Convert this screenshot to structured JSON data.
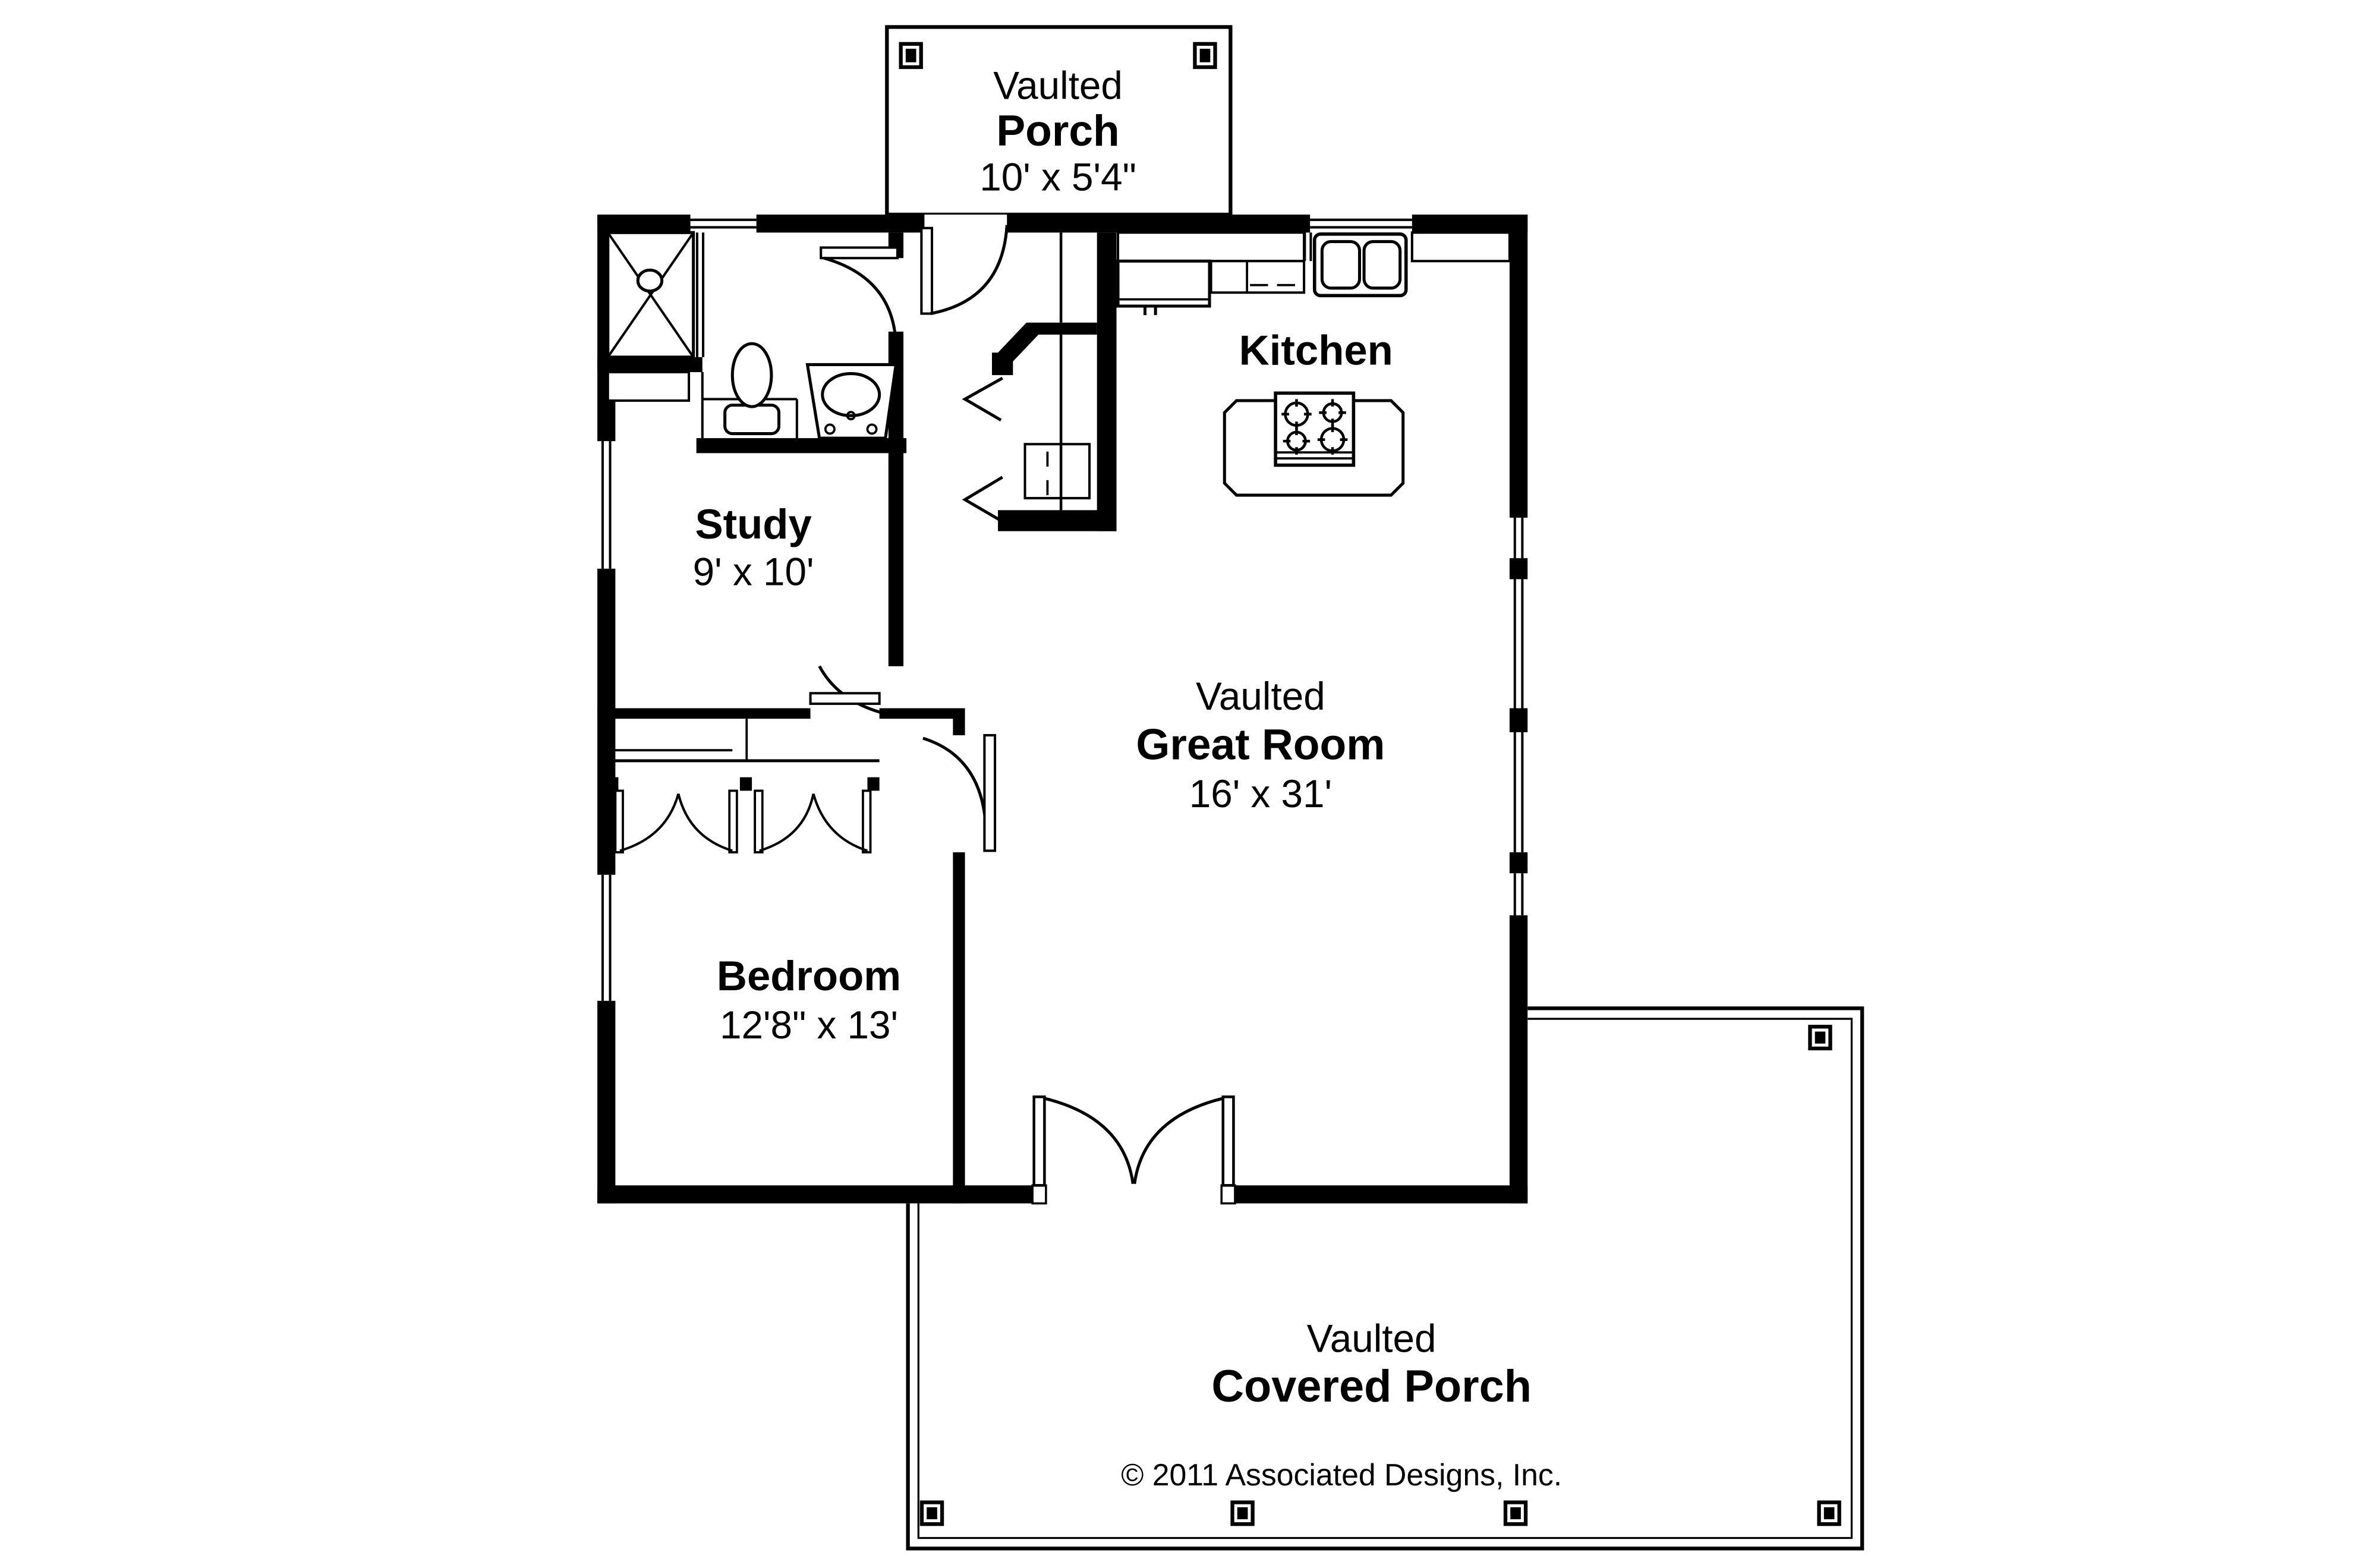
{
  "plan": {
    "title": "House floor plan",
    "colors": {
      "ink": "#000000",
      "paper": "#ffffff"
    },
    "porch_top": {
      "line1": "Vaulted",
      "line2": "Porch",
      "line3": "10' x 5'4\""
    },
    "kitchen": {
      "name": "Kitchen"
    },
    "study": {
      "name": "Study",
      "dims": "9' x 10'"
    },
    "great_room": {
      "line1": "Vaulted",
      "line2": "Great Room",
      "line3": "16' x 31'"
    },
    "bedroom": {
      "name": "Bedroom",
      "dims": "12'8\" x 13'"
    },
    "covered_porch": {
      "line1": "Vaulted",
      "line2": "Covered Porch"
    },
    "copyright": "© 2011 Associated Designs, Inc.",
    "fixtures": [
      "shower",
      "toilet",
      "vanity-sink",
      "kitchen-sink",
      "refrigerator",
      "cooktop-island",
      "water-heater",
      "closet-doors",
      "french-doors"
    ]
  }
}
